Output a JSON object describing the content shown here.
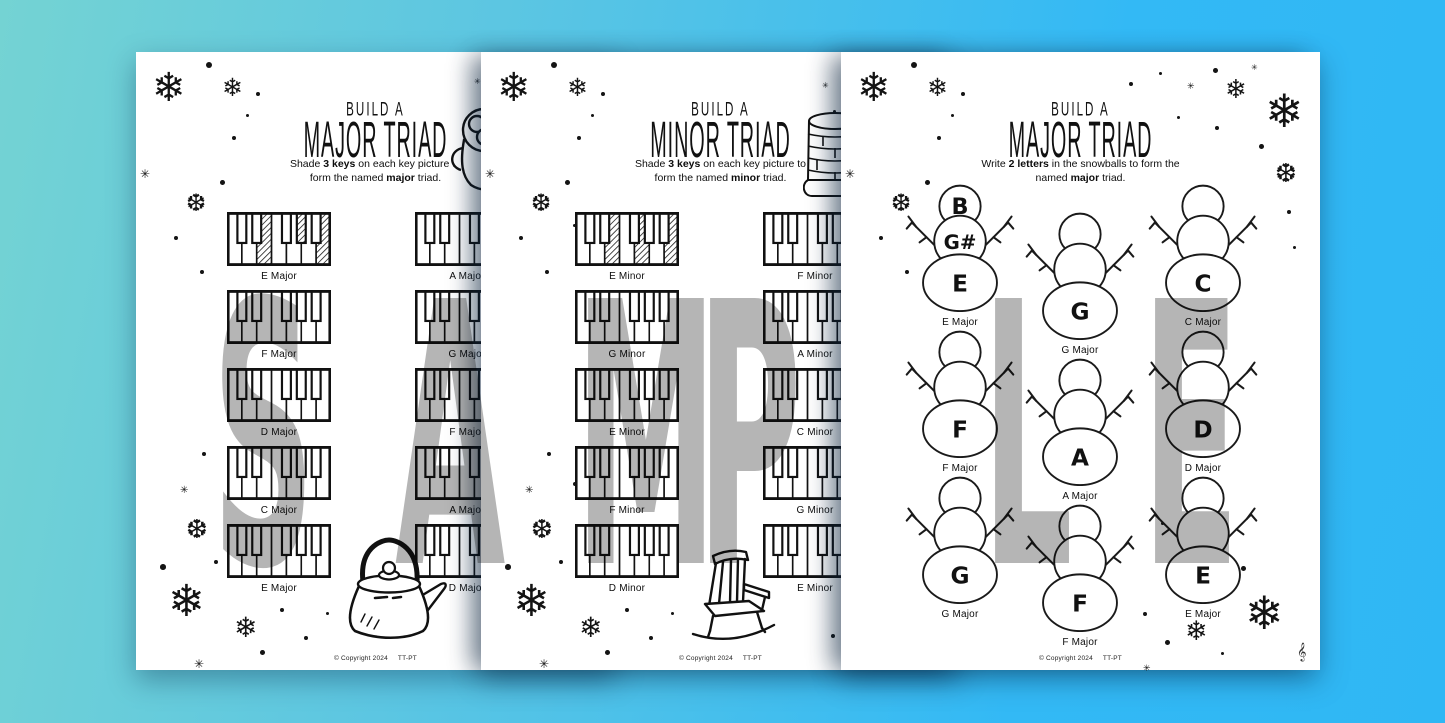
{
  "watermark": {
    "text": "SAMPLE",
    "letters": [
      "S",
      "A",
      "M",
      "P",
      "L",
      "E"
    ],
    "color": "#b5b5b5"
  },
  "background": {
    "gradient_start": "#74d3d3",
    "gradient_end": "#2fb7f4",
    "paper": "#ffffff"
  },
  "pages": [
    {
      "name": "build-a-major-triad-keyboards",
      "title_small": "BUILD A",
      "title_big": "MAJOR TRIAD",
      "instruction": {
        "pre": "Shade ",
        "bold1": "3 keys",
        "mid": " on each key picture to form the named ",
        "bold2": "major",
        "post": " triad."
      },
      "illustrations": [
        "hot-cocoa-mug",
        "kettle"
      ],
      "keyboards_left": [
        {
          "label": "E Major",
          "shaded": [
            "E",
            "G#",
            "B"
          ]
        },
        {
          "label": "F Major",
          "shaded": []
        },
        {
          "label": "D Major",
          "shaded": []
        },
        {
          "label": "C Major",
          "shaded": []
        },
        {
          "label": "E Major",
          "shaded": []
        }
      ],
      "keyboards_right": [
        {
          "label": "A Major",
          "shaded": []
        },
        {
          "label": "G Major",
          "shaded": []
        },
        {
          "label": "F Major",
          "shaded": []
        },
        {
          "label": "A Major",
          "shaded": []
        },
        {
          "label": "D Major",
          "shaded": []
        }
      ],
      "copyright": {
        "left": "© Copyright 2024",
        "right": "TT-PT"
      },
      "decorations": [
        {
          "g": "❄",
          "x": 16,
          "y": 16,
          "s": 40
        },
        {
          "g": "❄",
          "x": 86,
          "y": 24,
          "s": 25
        },
        {
          "g": "•",
          "x": 70,
          "y": 10,
          "s": 8
        },
        {
          "g": "•",
          "x": 120,
          "y": 40,
          "s": 5
        },
        {
          "g": "•",
          "x": 110,
          "y": 62,
          "s": 4
        },
        {
          "g": "✳",
          "x": 4,
          "y": 116,
          "s": 12
        },
        {
          "g": "❆",
          "x": 50,
          "y": 140,
          "s": 24
        },
        {
          "g": "•",
          "x": 96,
          "y": 84,
          "s": 5
        },
        {
          "g": "•",
          "x": 84,
          "y": 128,
          "s": 6
        },
        {
          "g": "•",
          "x": 38,
          "y": 184,
          "s": 5
        },
        {
          "g": "•",
          "x": 92,
          "y": 172,
          "s": 4
        },
        {
          "g": "•",
          "x": 64,
          "y": 218,
          "s": 5
        },
        {
          "g": "•",
          "x": 108,
          "y": 204,
          "s": 4
        },
        {
          "g": "✳",
          "x": 338,
          "y": 26,
          "s": 8
        },
        {
          "g": "•",
          "x": 350,
          "y": 58,
          "s": 4
        },
        {
          "g": "•",
          "x": 66,
          "y": 400,
          "s": 5
        },
        {
          "g": "✳",
          "x": 44,
          "y": 434,
          "s": 10
        },
        {
          "g": "•",
          "x": 92,
          "y": 430,
          "s": 5
        },
        {
          "g": "❆",
          "x": 50,
          "y": 464,
          "s": 26
        },
        {
          "g": "•",
          "x": 24,
          "y": 512,
          "s": 7
        },
        {
          "g": "•",
          "x": 78,
          "y": 508,
          "s": 5
        },
        {
          "g": "❄",
          "x": 32,
          "y": 528,
          "s": 44
        },
        {
          "g": "❄",
          "x": 98,
          "y": 562,
          "s": 28
        },
        {
          "g": "•",
          "x": 144,
          "y": 556,
          "s": 5
        },
        {
          "g": "✳",
          "x": 58,
          "y": 606,
          "s": 12
        },
        {
          "g": "•",
          "x": 124,
          "y": 598,
          "s": 6
        },
        {
          "g": "•",
          "x": 168,
          "y": 584,
          "s": 5
        },
        {
          "g": "•",
          "x": 190,
          "y": 560,
          "s": 4
        }
      ]
    },
    {
      "name": "build-a-minor-triad-keyboards",
      "title_small": "BUILD A",
      "title_big": "MINOR TRIAD",
      "instruction": {
        "pre": "Shade ",
        "bold1": "3 keys",
        "mid": " on each key picture to form the named ",
        "bold2": "minor",
        "post": " triad."
      },
      "illustrations": [
        "brick-fireplace",
        "rocking-chair"
      ],
      "keyboards_left": [
        {
          "label": "E Minor",
          "shaded": [
            "E",
            "G",
            "B"
          ]
        },
        {
          "label": "G Minor",
          "shaded": []
        },
        {
          "label": "E Minor",
          "shaded": []
        },
        {
          "label": "F Minor",
          "shaded": []
        },
        {
          "label": "D Minor",
          "shaded": []
        }
      ],
      "keyboards_right": [
        {
          "label": "F Minor",
          "shaded": []
        },
        {
          "label": "A Minor",
          "shaded": []
        },
        {
          "label": "C Minor",
          "shaded": []
        },
        {
          "label": "G Minor",
          "shaded": []
        },
        {
          "label": "E Minor",
          "shaded": []
        }
      ],
      "copyright": {
        "left": "© Copyright 2024",
        "right": "TT-PT"
      },
      "decorations": [
        {
          "g": "❄",
          "x": 16,
          "y": 16,
          "s": 40
        },
        {
          "g": "❄",
          "x": 86,
          "y": 24,
          "s": 25
        },
        {
          "g": "•",
          "x": 70,
          "y": 10,
          "s": 8
        },
        {
          "g": "•",
          "x": 120,
          "y": 40,
          "s": 5
        },
        {
          "g": "•",
          "x": 110,
          "y": 62,
          "s": 4
        },
        {
          "g": "✳",
          "x": 4,
          "y": 116,
          "s": 12
        },
        {
          "g": "❆",
          "x": 50,
          "y": 140,
          "s": 24
        },
        {
          "g": "•",
          "x": 96,
          "y": 84,
          "s": 5
        },
        {
          "g": "•",
          "x": 84,
          "y": 128,
          "s": 6
        },
        {
          "g": "•",
          "x": 38,
          "y": 184,
          "s": 5
        },
        {
          "g": "•",
          "x": 92,
          "y": 172,
          "s": 4
        },
        {
          "g": "•",
          "x": 64,
          "y": 218,
          "s": 5
        },
        {
          "g": "•",
          "x": 108,
          "y": 204,
          "s": 4
        },
        {
          "g": "✳",
          "x": 341,
          "y": 30,
          "s": 8
        },
        {
          "g": "•",
          "x": 352,
          "y": 58,
          "s": 4
        },
        {
          "g": "•",
          "x": 350,
          "y": 582,
          "s": 5
        },
        {
          "g": "•",
          "x": 66,
          "y": 400,
          "s": 5
        },
        {
          "g": "✳",
          "x": 44,
          "y": 434,
          "s": 10
        },
        {
          "g": "•",
          "x": 92,
          "y": 430,
          "s": 5
        },
        {
          "g": "❆",
          "x": 50,
          "y": 464,
          "s": 26
        },
        {
          "g": "•",
          "x": 24,
          "y": 512,
          "s": 7
        },
        {
          "g": "•",
          "x": 78,
          "y": 508,
          "s": 5
        },
        {
          "g": "❄",
          "x": 32,
          "y": 528,
          "s": 44
        },
        {
          "g": "❄",
          "x": 98,
          "y": 562,
          "s": 28
        },
        {
          "g": "•",
          "x": 144,
          "y": 556,
          "s": 5
        },
        {
          "g": "✳",
          "x": 58,
          "y": 606,
          "s": 12
        },
        {
          "g": "•",
          "x": 124,
          "y": 598,
          "s": 6
        },
        {
          "g": "•",
          "x": 168,
          "y": 584,
          "s": 5
        },
        {
          "g": "•",
          "x": 190,
          "y": 560,
          "s": 4
        }
      ]
    },
    {
      "name": "build-a-major-triad-snowmen",
      "title_small": "BUILD A",
      "title_big": "MAJOR TRIAD",
      "instruction": {
        "pre": "Write ",
        "bold1": "2 letters",
        "mid": " in the snowballs to form the named ",
        "bold2": "major",
        "post": " triad."
      },
      "illustrations": [],
      "clef": "𝄞",
      "snowmen": [
        {
          "label": "E Major",
          "head": "B",
          "middle": "G#",
          "bottom": "E"
        },
        {
          "label": "G Major",
          "head": "",
          "middle": "",
          "bottom": "G"
        },
        {
          "label": "C Major",
          "head": "",
          "middle": "",
          "bottom": "C"
        },
        {
          "label": "F Major",
          "head": "",
          "middle": "",
          "bottom": "F"
        },
        {
          "label": "A Major",
          "head": "",
          "middle": "",
          "bottom": "A"
        },
        {
          "label": "D Major",
          "head": "",
          "middle": "",
          "bottom": "D"
        },
        {
          "label": "G Major",
          "head": "",
          "middle": "",
          "bottom": "G"
        },
        {
          "label": "F Major",
          "head": "",
          "middle": "",
          "bottom": "F"
        },
        {
          "label": "E Major",
          "head": "",
          "middle": "",
          "bottom": "E"
        }
      ],
      "copyright": {
        "left": "© Copyright 2024",
        "right": "TT-PT"
      },
      "decorations": [
        {
          "g": "❄",
          "x": 16,
          "y": 16,
          "s": 40
        },
        {
          "g": "❄",
          "x": 86,
          "y": 24,
          "s": 25
        },
        {
          "g": "•",
          "x": 70,
          "y": 10,
          "s": 8
        },
        {
          "g": "•",
          "x": 120,
          "y": 40,
          "s": 5
        },
        {
          "g": "•",
          "x": 110,
          "y": 62,
          "s": 4
        },
        {
          "g": "✳",
          "x": 4,
          "y": 116,
          "s": 12
        },
        {
          "g": "❆",
          "x": 50,
          "y": 140,
          "s": 24
        },
        {
          "g": "•",
          "x": 96,
          "y": 84,
          "s": 5
        },
        {
          "g": "•",
          "x": 84,
          "y": 128,
          "s": 6
        },
        {
          "g": "•",
          "x": 38,
          "y": 184,
          "s": 5
        },
        {
          "g": "•",
          "x": 64,
          "y": 218,
          "s": 5
        },
        {
          "g": "•",
          "x": 288,
          "y": 30,
          "s": 5
        },
        {
          "g": "•",
          "x": 318,
          "y": 20,
          "s": 4
        },
        {
          "g": "✳",
          "x": 346,
          "y": 30,
          "s": 9
        },
        {
          "g": "•",
          "x": 372,
          "y": 16,
          "s": 6
        },
        {
          "g": "❄",
          "x": 384,
          "y": 24,
          "s": 26
        },
        {
          "g": "❄",
          "x": 424,
          "y": 36,
          "s": 46
        },
        {
          "g": "✳",
          "x": 410,
          "y": 12,
          "s": 8
        },
        {
          "g": "•",
          "x": 336,
          "y": 64,
          "s": 4
        },
        {
          "g": "•",
          "x": 374,
          "y": 74,
          "s": 5
        },
        {
          "g": "•",
          "x": 418,
          "y": 92,
          "s": 6
        },
        {
          "g": "❆",
          "x": 434,
          "y": 108,
          "s": 26
        },
        {
          "g": "•",
          "x": 446,
          "y": 158,
          "s": 5
        },
        {
          "g": "•",
          "x": 452,
          "y": 194,
          "s": 4
        },
        {
          "g": "•",
          "x": 320,
          "y": 470,
          "s": 4
        },
        {
          "g": "✳",
          "x": 338,
          "y": 498,
          "s": 10
        },
        {
          "g": "•",
          "x": 368,
          "y": 486,
          "s": 5
        },
        {
          "g": "❆",
          "x": 352,
          "y": 522,
          "s": 26
        },
        {
          "g": "•",
          "x": 400,
          "y": 514,
          "s": 6
        },
        {
          "g": "❄",
          "x": 404,
          "y": 538,
          "s": 46
        },
        {
          "g": "❄",
          "x": 344,
          "y": 566,
          "s": 27
        },
        {
          "g": "•",
          "x": 302,
          "y": 560,
          "s": 5
        },
        {
          "g": "•",
          "x": 324,
          "y": 588,
          "s": 6
        },
        {
          "g": "•",
          "x": 380,
          "y": 600,
          "s": 4
        },
        {
          "g": "✳",
          "x": 302,
          "y": 612,
          "s": 9
        }
      ]
    }
  ]
}
